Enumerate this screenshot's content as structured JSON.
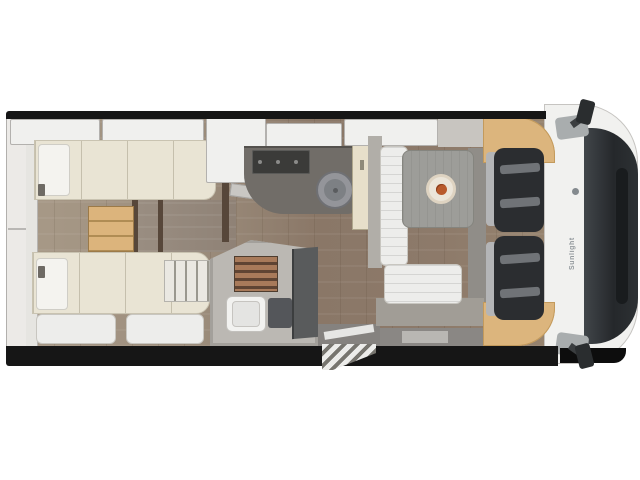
{
  "scene": {
    "description": "Top-down 3D rendered floor plan of a coachbuilt motorhome on a white background",
    "brand_label": "Sunlight"
  },
  "palette": {
    "background": "#ffffff",
    "outline_black": "#161616",
    "floor_wood_dark": "#8a7767",
    "floor_wood_light": "#a79987",
    "furniture_cream": "#e9e4d4",
    "cushion_white": "#ededeb",
    "counter_gray": "#716d68",
    "hob_black": "#3b3b39",
    "table_gray": "#9d9d99",
    "step_wood_tan": "#dcb47c",
    "dashboard_tan": "#dcb57d",
    "shower_slats_brown": "#a87a5a",
    "seat_dark": "#2b2d30",
    "seat_trim_gray": "#b4b5b7",
    "cab_white": "#f1f1ef",
    "windshield_dark": "#25282b",
    "bathroom_door_gray": "#595b5c",
    "flower_orange": "#b85a2c"
  },
  "regions": [
    "rear-twin-single-beds",
    "bed-steps",
    "overhead-lockers",
    "rear-garage-wall",
    "kitchen-counter",
    "hob",
    "round-sink",
    "fridge-cabinet",
    "wardrobe",
    "bathroom",
    "shower-grate",
    "cassette-toilet",
    "bathroom-door",
    "entry-door",
    "entry-step",
    "dinette-table",
    "bench-seats",
    "swivel-cab-seats",
    "dashboard-wood-trim",
    "driver-cab",
    "wing-mirrors"
  ]
}
